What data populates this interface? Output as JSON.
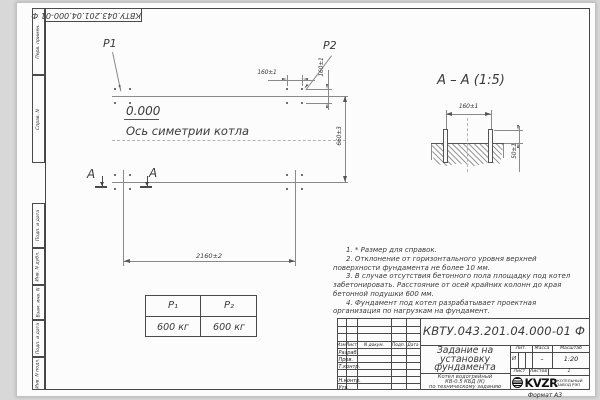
{
  "sheet": {
    "doc_number": "КВТУ.043.201.04.000-01 Ф",
    "format_label": "Формат А3"
  },
  "frame_labels": [
    "Перв. примен.",
    "Справ. N",
    "Подп. и дата",
    "Инв. N дубл.",
    "Взам. инв. N",
    "Подп. и дата",
    "Инв. N подл."
  ],
  "plan": {
    "load_label_1": "P1",
    "load_label_2": "P2",
    "level_mark": "0.000",
    "axis_label": "Ось симетрии котла",
    "section_letter": "A",
    "dim_bolt_x": "160±1",
    "dim_bolt_y": "160±1",
    "dim_width": "660±3",
    "dim_length": "2160±2"
  },
  "section_view": {
    "title": "А – А (1:5)",
    "dim_bolt_spacing": "160±1",
    "dim_bolt_height": "50±1"
  },
  "notes": [
    "1. * Размер для справок.",
    "2. Отклонение от горизонтального уровня верхней поверхности фундамента не более 10 мм.",
    "3. В случае отсутствия бетонного пола площадку под котел забетонировать. Расстояние от осей крайних колонн до края бетонной подушки 600 мм.",
    "4. Фундамент под котел разрабатывает проектная организация по нагрузкам на фундамент."
  ],
  "load_table": {
    "col1_header": "P₁",
    "col2_header": "P₂",
    "col1_value": "600 кг",
    "col2_value": "600 кг"
  },
  "title_block": {
    "designation": "КВТУ.043.201.04.000-01 Ф",
    "title_lines": [
      "Задание на",
      "установку",
      "фундамента"
    ],
    "product_lines": [
      "Котел водогрейный",
      "КВ-0.5 КБД (К)",
      "по техническому заданию"
    ],
    "change_header": [
      "Изм.",
      "Лист",
      "N докум.",
      "Подп.",
      "Дата"
    ],
    "signature_rows": [
      "Разраб.",
      "Пров.",
      "Т.контр.",
      "Н.контр.",
      "Утв."
    ],
    "lit_header": "Лит.",
    "mass_header": "Масса",
    "scale_header": "Масштаб",
    "lit_value": "И",
    "mass_value": "–",
    "scale_value": "1:20",
    "sheet_label": "Лист",
    "sheets_label": "Листов",
    "sheets_value": "1",
    "logo_text": "KVZR",
    "logo_caption_lines": [
      "КОТЕЛЬНЫЙ",
      "ЗАВОД РЭП"
    ]
  }
}
